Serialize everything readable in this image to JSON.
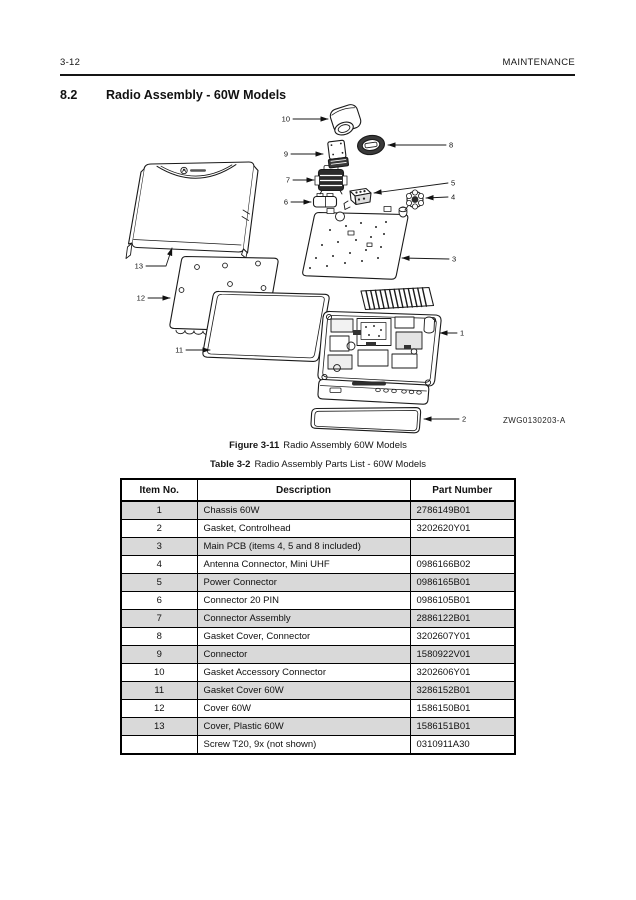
{
  "page": {
    "header_left": "3-12",
    "header_right": "MAINTENANCE",
    "section_number": "8.2",
    "section_title": "Radio Assembly - 60W Models",
    "figure_caption_label": "Figure 3-11",
    "figure_caption_text": "Radio Assembly 60W Models",
    "table_caption_label": "Table 3-2",
    "table_caption_text": "Radio Assembly Parts List - 60W Models"
  },
  "diagram": {
    "watermark": "ZWG0130203-A",
    "callouts": [
      "1",
      "2",
      "3",
      "4",
      "5",
      "6",
      "7",
      "8",
      "9",
      "10",
      "11",
      "12",
      "13"
    ]
  },
  "table": {
    "headers": [
      "Item No.",
      "Description",
      "Part Number"
    ],
    "rows": [
      {
        "item": "1",
        "description": "Chassis 60W",
        "part": "2786149B01"
      },
      {
        "item": "2",
        "description": "Gasket, Controlhead",
        "part": "3202620Y01"
      },
      {
        "item": "3",
        "description": "Main PCB (items 4, 5 and 8 included)",
        "part": ""
      },
      {
        "item": "4",
        "description": "Antenna Connector, Mini UHF",
        "part": "0986166B02"
      },
      {
        "item": "5",
        "description": "Power Connector",
        "part": "0986165B01"
      },
      {
        "item": "6",
        "description": "Connector 20 PIN",
        "part": "0986105B01"
      },
      {
        "item": "7",
        "description": "Connector Assembly",
        "part": "2886122B01"
      },
      {
        "item": "8",
        "description": "Gasket Cover, Connector",
        "part": "3202607Y01"
      },
      {
        "item": "9",
        "description": "Connector",
        "part": "1580922V01"
      },
      {
        "item": "10",
        "description": "Gasket Accessory Connector",
        "part": "3202606Y01"
      },
      {
        "item": "11",
        "description": "Gasket Cover 60W",
        "part": "3286152B01"
      },
      {
        "item": "12",
        "description": "Cover 60W",
        "part": "1586150B01"
      },
      {
        "item": "13",
        "description": "Cover, Plastic 60W",
        "part": "1586151B01"
      },
      {
        "item": "",
        "description": "Screw T20, 9x (not shown)",
        "part": "0310911A30"
      }
    ]
  },
  "colors": {
    "ink": "#151515",
    "row_shade": "#d9d9d9",
    "page_background": "#ffffff"
  }
}
